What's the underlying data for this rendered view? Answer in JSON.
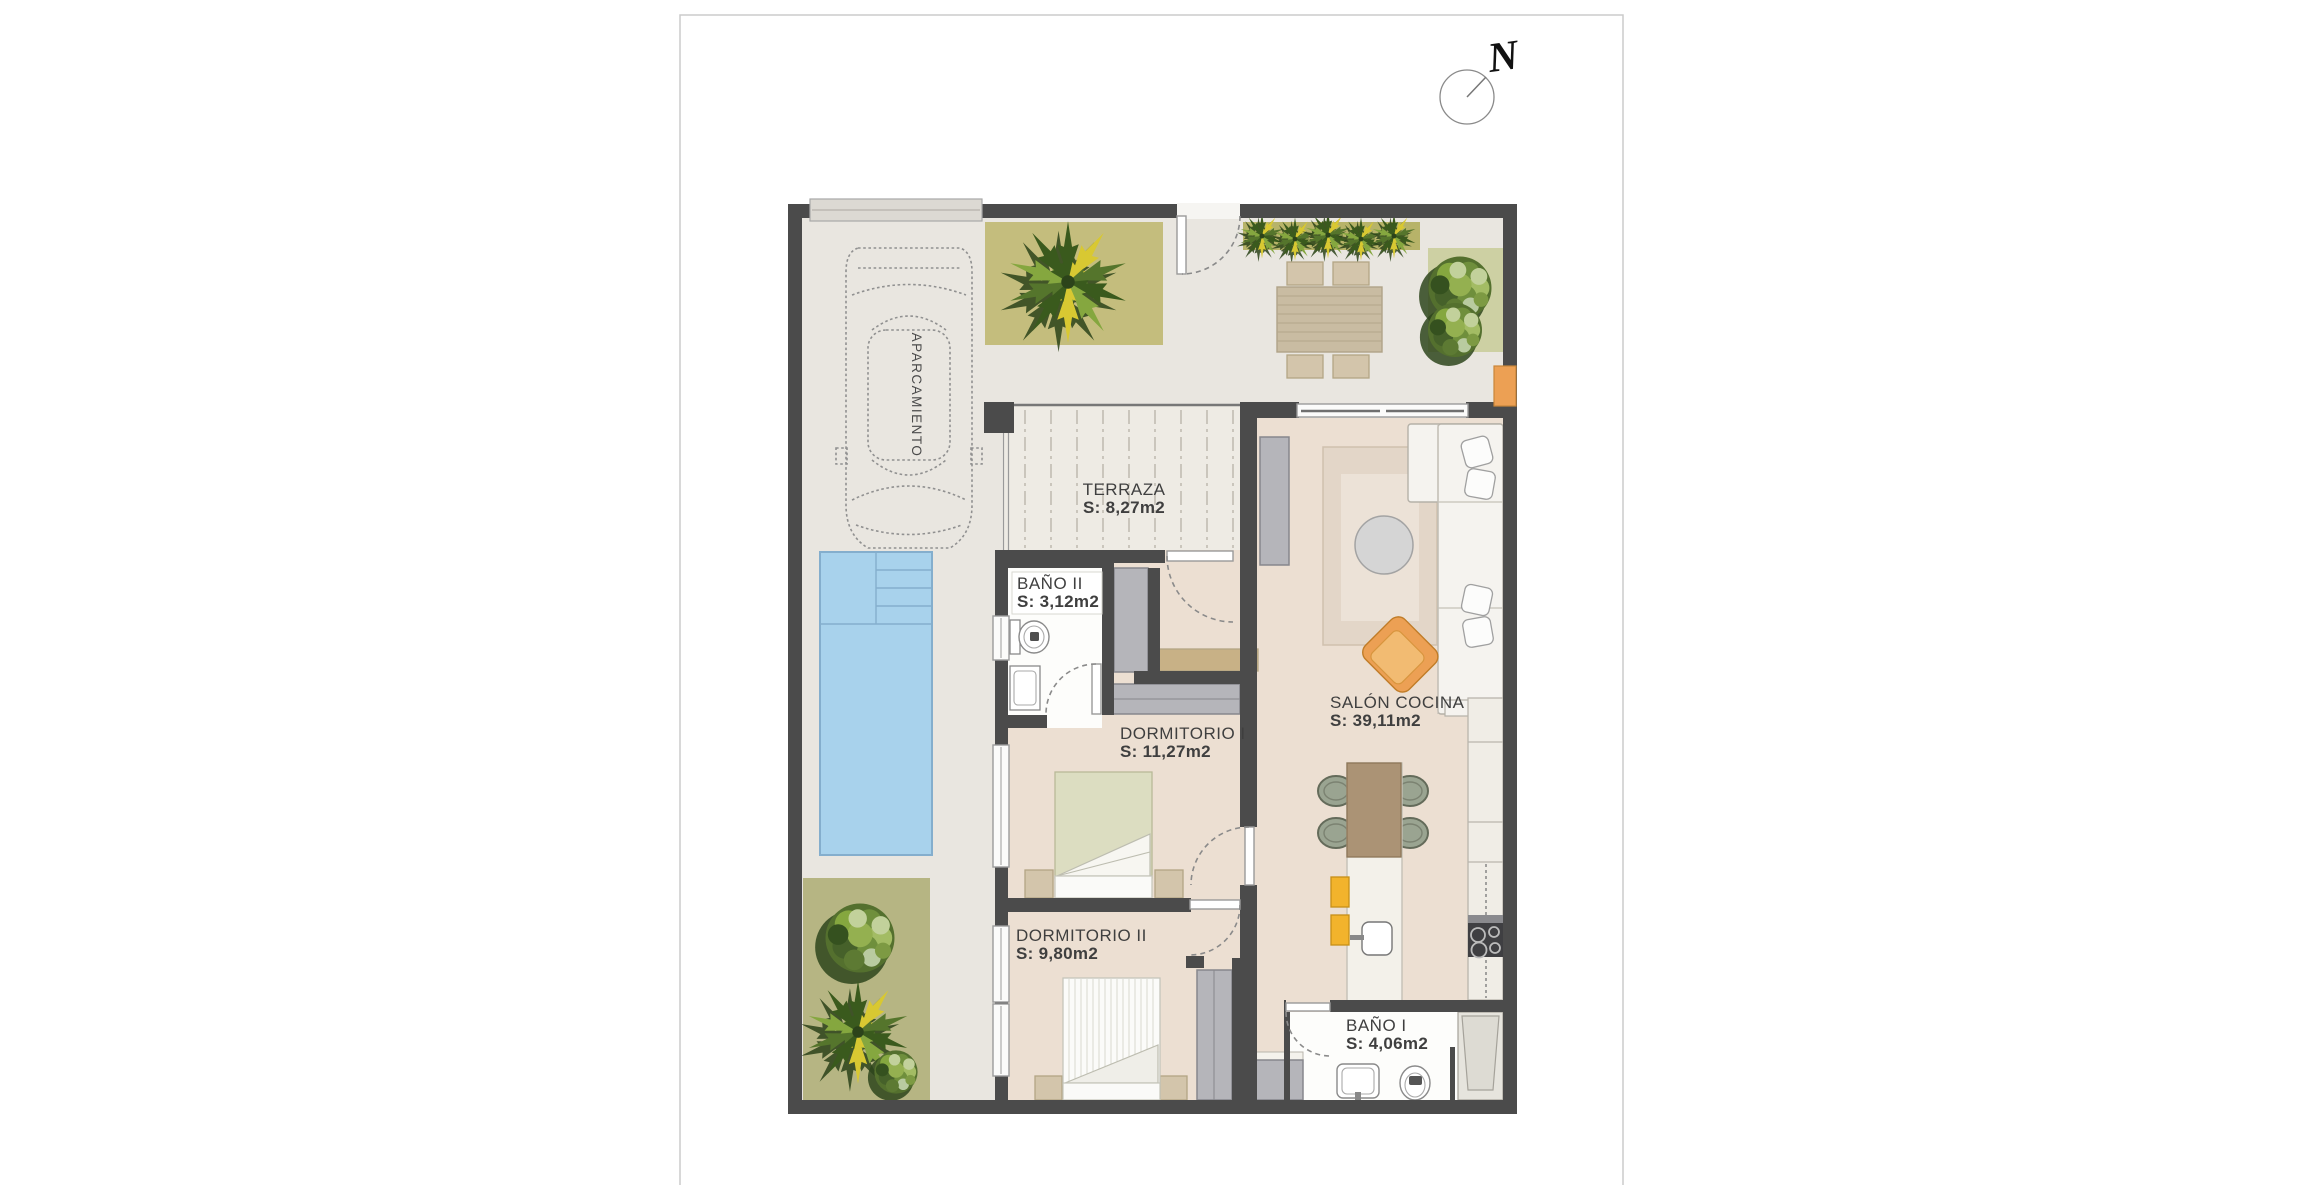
{
  "sheet": {
    "background": "#ffffff",
    "border": "#cbcbcb"
  },
  "compass": {
    "label": "N"
  },
  "rooms": [
    {
      "id": "aparcamiento",
      "name": "APARCAMIENTO",
      "area": ""
    },
    {
      "id": "terraza",
      "name": "TERRAZA",
      "area": "S: 8,27m2"
    },
    {
      "id": "bano-ii",
      "name": "BAÑO II",
      "area": "S: 3,12m2"
    },
    {
      "id": "dormitorio-i",
      "name": "DORMITORIO I",
      "area": "S: 11,27m2"
    },
    {
      "id": "salon-cocina",
      "name": "SALÓN COCINA",
      "area": "S: 39,11m2"
    },
    {
      "id": "dormitorio-ii",
      "name": "DORMITORIO II",
      "area": "S: 9,80m2"
    },
    {
      "id": "bano-i",
      "name": "BAÑO I",
      "area": "S: 4,06m2"
    }
  ],
  "colors": {
    "wall": "#4b4b4b",
    "outdoor": "#e9e6e0",
    "floor": "#ecdfd2",
    "terrace": "#eeebe4",
    "bathfloor": "#fdfdfb",
    "pool": "#a8d2ec",
    "pooledge": "#84aecd",
    "planter": "#c4bd7d",
    "hedge": "#b7b369",
    "bushbed": "#cdd0a3",
    "lawn": "#b6b583",
    "tan": "#d3c5ab",
    "wood": "#c8b186",
    "brown": "#ab9375",
    "grayfurn": "#b5b5ba",
    "island": "#f3f1ea",
    "counter": "#f0ede6",
    "yellow": "#f2b32c",
    "orange": "#eca054",
    "rugouter": "#e3d6c8",
    "ruginner": "#ece2d7",
    "sofa": "#f5f3ef",
    "hob": "#3f3f42",
    "bedgreen": "#dcddc1",
    "text": "#3f3f3f"
  }
}
